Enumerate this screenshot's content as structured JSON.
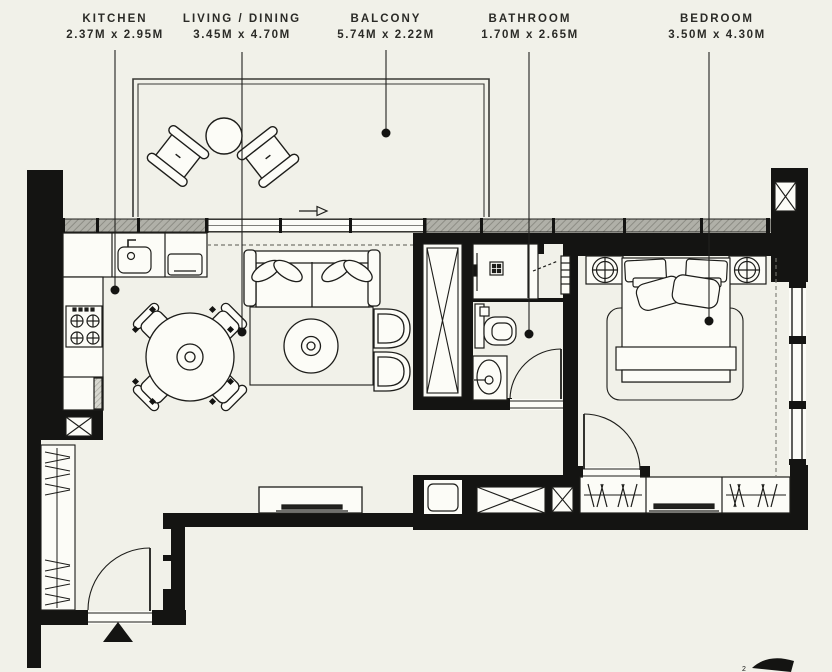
{
  "plan_title": "Apartment Floor Plan",
  "rooms": [
    {
      "name": "KITCHEN",
      "dims": "2.37M x 2.95M"
    },
    {
      "name": "LIVING / DINING",
      "dims": "3.45M x 4.70M"
    },
    {
      "name": "BALCONY",
      "dims": "5.74M x 2.22M"
    },
    {
      "name": "BATHROOM",
      "dims": "1.70M x 2.65M"
    },
    {
      "name": "BEDROOM",
      "dims": "3.50M x 4.30M"
    }
  ],
  "corner_mark": "2",
  "colors": {
    "background": "#f1f1e9",
    "wall": "#141412",
    "line": "#1d1d1a",
    "glazing_hatch": "#b0b0a8",
    "fixture_fill": "#fcfcf7"
  },
  "icons": {
    "balcony": [
      "balcony-armchair-icon",
      "balcony-round-table-icon",
      "entrance-arrow-icon"
    ],
    "kitchen": [
      "sink-icon",
      "oven-icon",
      "hob-icon",
      "cabinet-icon",
      "duct-shaft-icon"
    ],
    "living": [
      "sofa-icon",
      "coffee-table-icon",
      "rug-icon",
      "accent-chair-icon",
      "tv-console-icon",
      "dining-table-icon",
      "dining-chair-icon"
    ],
    "bathroom": [
      "shower-icon",
      "toilet-icon",
      "vanity-basin-icon",
      "door-swing-icon",
      "linen-shaft-icon"
    ],
    "utility": [
      "washer-icon",
      "duct-shaft-icon"
    ],
    "bedroom": [
      "double-bed-icon",
      "nightstand-lamp-icon",
      "wardrobe-hangers-icon",
      "tv-dresser-icon",
      "curtain-dashed-icon",
      "window-icon"
    ],
    "entry": [
      "entry-door-icon",
      "entry-triangle-icon",
      "coat-wardrobe-icon"
    ]
  }
}
